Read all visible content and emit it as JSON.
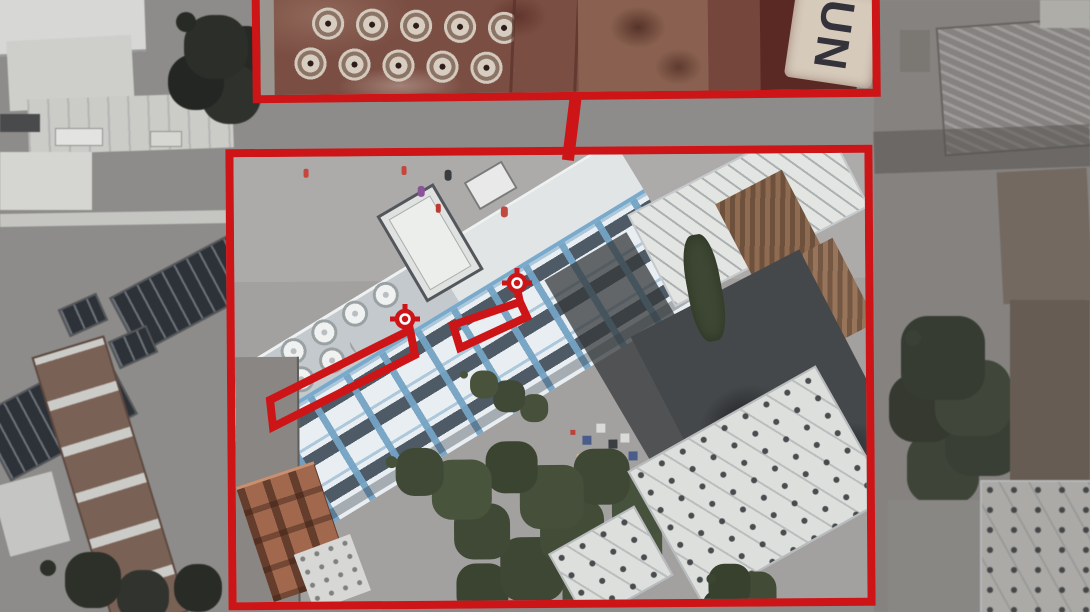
{
  "annotations": {
    "accent_color": "#cd1417",
    "roof_marking": "UN",
    "views": [
      "roof-closeup-inset",
      "building-overview"
    ],
    "targets": [
      "target-reticle-1",
      "target-reticle-2"
    ],
    "highlighted_zones": [
      "upper-floor-window-row",
      "lower-floor-window-row"
    ]
  }
}
